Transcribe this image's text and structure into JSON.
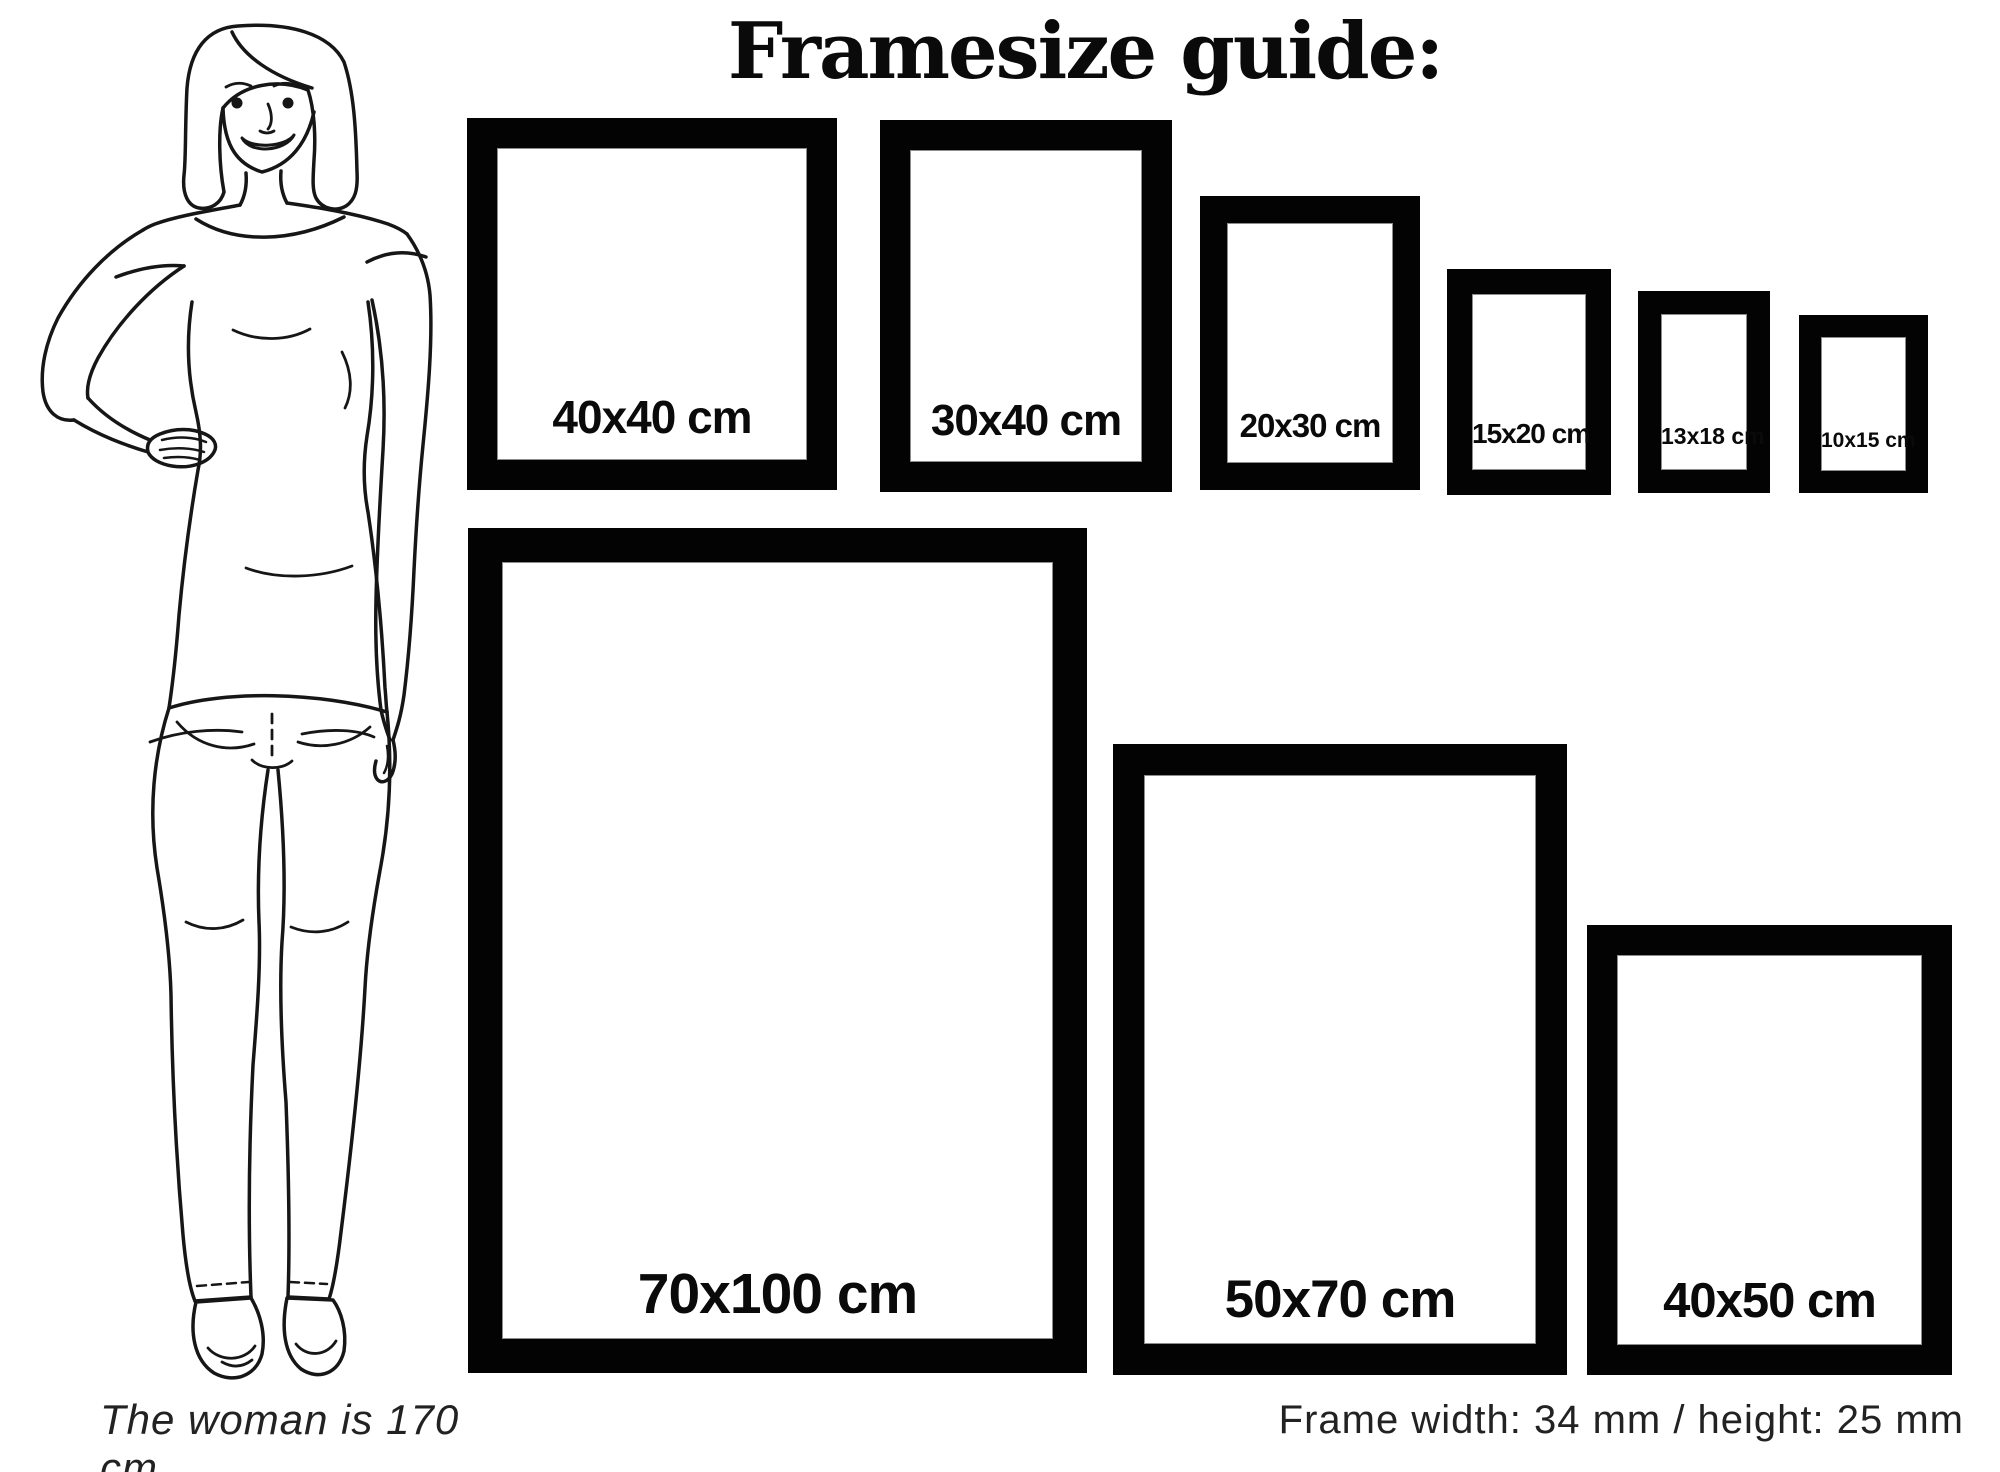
{
  "title": "Framesize guide:",
  "frames": {
    "top_row": [
      {
        "size": "40x40",
        "label": "40x40 cm"
      },
      {
        "size": "30x40",
        "label": "30x40 cm"
      },
      {
        "size": "20x30",
        "label": "20x30 cm"
      },
      {
        "size": "15x20",
        "label": "15x20 cm"
      },
      {
        "size": "13x18",
        "label": "13x18 cm"
      },
      {
        "size": "10x15",
        "label": "10x15 cm"
      }
    ],
    "bottom_row": [
      {
        "size": "70x100",
        "label": "70x100 cm"
      },
      {
        "size": "50x70",
        "label": "50x70 cm"
      },
      {
        "size": "40x50",
        "label": "40x50 cm"
      }
    ]
  },
  "woman": {
    "caption": "The woman is 170 cm"
  },
  "footer_note": "Frame width: 34 mm / height: 25 mm",
  "colors": {
    "frame": "#000000",
    "background": "#ffffff",
    "text": "#0a0a0a"
  }
}
